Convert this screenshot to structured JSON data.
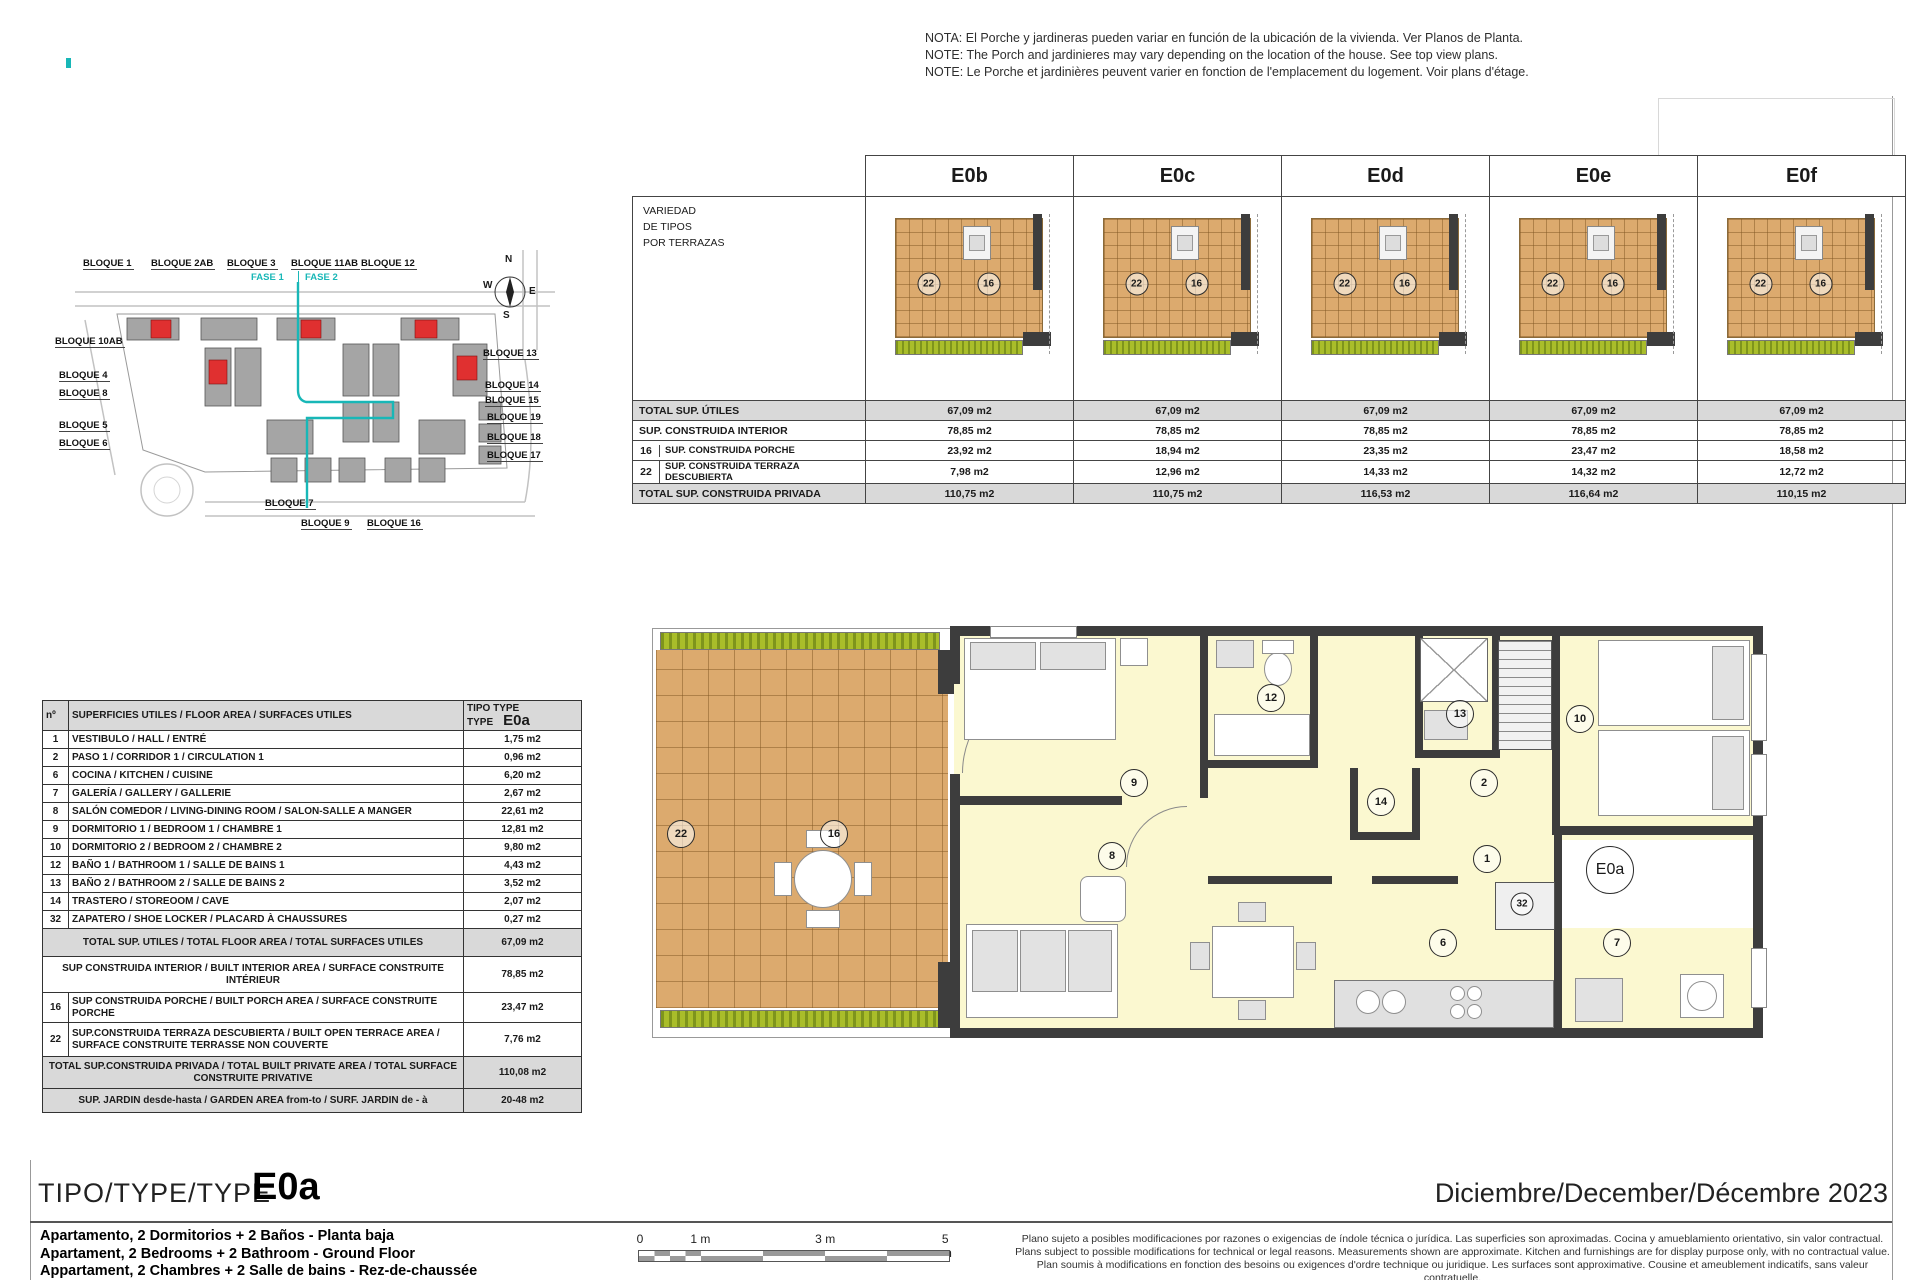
{
  "colors": {
    "accent_teal": "#18b7b7",
    "wall": "#3d3d3d",
    "room_fill": "#fbf8d0",
    "tile": "#dcaa6e",
    "garden": "#a9bd2a",
    "shade": "#d9d9d9",
    "red_block": "#e03030"
  },
  "notes": {
    "es": "NOTA: El Porche y jardineras pueden variar en función de la ubicación de la vivienda. Ver Planos de Planta.",
    "en": "NOTE: The Porch and jardinieres may vary depending on the location of the house. See top view plans.",
    "fr": "NOTE: Le Porche et jardinières peuvent varier en fonction de l'emplacement du logement. Voir plans d'étage."
  },
  "terrace_table": {
    "corner": {
      "l1": "VARIEDAD",
      "l2": "DE TIPOS",
      "l3": "POR TERRAZAS"
    },
    "types": [
      "E0b",
      "E0c",
      "E0d",
      "E0e",
      "E0f"
    ],
    "badge_left": "22",
    "badge_right": "16",
    "rows": [
      {
        "num": "",
        "label": "TOTAL SUP. ÚTILES",
        "values": [
          "67,09 m2",
          "67,09 m2",
          "67,09 m2",
          "67,09 m2",
          "67,09 m2"
        ]
      },
      {
        "num": "",
        "label": "SUP. CONSTRUIDA INTERIOR",
        "values": [
          "78,85 m2",
          "78,85 m2",
          "78,85 m2",
          "78,85 m2",
          "78,85 m2"
        ]
      },
      {
        "num": "16",
        "label": "SUP. CONSTRUIDA  PORCHE",
        "values": [
          "23,92 m2",
          "18,94 m2",
          "23,35 m2",
          "23,47 m2",
          "18,58 m2"
        ]
      },
      {
        "num": "22",
        "label": "SUP. CONSTRUIDA TERRAZA DESCUBIERTA",
        "values": [
          "7,98 m2",
          "12,96 m2",
          "14,33 m2",
          "14,32 m2",
          "12,72 m2"
        ]
      },
      {
        "num": "",
        "label": "TOTAL SUP. CONSTRUIDA PRIVADA",
        "values": [
          "110,75 m2",
          "110,75 m2",
          "116,53 m2",
          "116,64 m2",
          "110,15 m2"
        ]
      }
    ]
  },
  "site_plan": {
    "fase1": "FASE 1",
    "fase2": "FASE 2",
    "compass": {
      "n": "N",
      "e": "E",
      "s": "S",
      "w": "W"
    },
    "top": [
      "BLOQUE 1",
      "BLOQUE 2AB",
      "BLOQUE 3",
      "BLOQUE 11AB",
      "BLOQUE 12"
    ],
    "left": [
      "BLOQUE 10AB",
      "BLOQUE 4",
      "BLOQUE 8",
      "BLOQUE 5",
      "BLOQUE 6"
    ],
    "right": [
      "BLOQUE 13",
      "BLOQUE 14",
      "BLOQUE 15",
      "BLOQUE 19",
      "BLOQUE 18",
      "BLOQUE 17"
    ],
    "bottom": [
      "BLOQUE 7",
      "BLOQUE 9",
      "BLOQUE 16"
    ]
  },
  "area_table": {
    "header": {
      "num": "nº",
      "label": "SUPERFICIES UTILES / FLOOR AREA / SURFACES UTILES",
      "type1": "TIPO TYPE",
      "type2": "TYPE",
      "type_value": "E0a"
    },
    "rows": [
      {
        "num": "1",
        "label": "VESTIBULO / HALL / ENTRÉ",
        "value": "1,75 m2"
      },
      {
        "num": "2",
        "label": "PASO 1 / CORRIDOR 1 / CIRCULATION 1",
        "value": "0,96 m2"
      },
      {
        "num": "6",
        "label": "COCINA / KITCHEN / CUISINE",
        "value": "6,20 m2"
      },
      {
        "num": "7",
        "label": "GALERÍA / GALLERY / GALLERIE",
        "value": "2,67 m2"
      },
      {
        "num": "8",
        "label": "SALÓN COMEDOR  / LIVING-DINING ROOM / SALON-SALLE A MANGER",
        "value": "22,61 m2"
      },
      {
        "num": "9",
        "label": "DORMITORIO 1 / BEDROOM 1 / CHAMBRE 1",
        "value": "12,81 m2"
      },
      {
        "num": "10",
        "label": "DORMITORIO 2 / BEDROOM 2 / CHAMBRE 2",
        "value": "9,80 m2"
      },
      {
        "num": "12",
        "label": "BAÑO 1 / BATHROOM 1 / SALLE DE BAINS 1",
        "value": "4,43 m2"
      },
      {
        "num": "13",
        "label": "BAÑO 2 / BATHROOM 2 / SALLE DE BAINS 2",
        "value": "3,52 m2"
      },
      {
        "num": "14",
        "label": "TRASTERO / STOREOOM / CAVE",
        "value": "2,07 m2"
      },
      {
        "num": "32",
        "label": "ZAPATERO / SHOE LOCKER / PLACARD À CHAUSSURES",
        "value": "0,27 m2"
      }
    ],
    "summary": [
      {
        "num": "",
        "label": "TOTAL SUP. UTILES / TOTAL FLOOR AREA / TOTAL SURFACES UTILES",
        "value": "67,09 m2"
      },
      {
        "num": "",
        "label": "SUP CONSTRUIDA INTERIOR / BUILT INTERIOR AREA /  SURFACE CONSTRUITE INTÉRIEUR",
        "value": "78,85 m2"
      },
      {
        "num": "16",
        "label": "SUP CONSTRUIDA PORCHE  / BUILT PORCH  AREA / SURFACE CONSTRUITE PORCHE",
        "value": "23,47 m2"
      },
      {
        "num": "22",
        "label": "SUP.CONSTRUIDA TERRAZA DESCUBIERTA  / BUILT OPEN TERRACE  AREA / SURFACE CONSTRUITE TERRASSE NON COUVERTE",
        "value": "7,76 m2"
      },
      {
        "num": "",
        "label": "TOTAL SUP.CONSTRUIDA PRIVADA / TOTAL  BUILT PRIVATE  AREA / TOTAL SURFACE CONSTRUITE PRIVATIVE",
        "value": "110,08 m2"
      },
      {
        "num": "",
        "label": "SUP. JARDIN desde-hasta / GARDEN AREA from-to / SURF. JARDIN  de - à",
        "value": "20-48 m2"
      }
    ]
  },
  "plan": {
    "badges": {
      "t22": "22",
      "t16": "16",
      "r9": "9",
      "r8": "8",
      "r12": "12",
      "r14": "14",
      "r13": "13",
      "r2": "2",
      "r10": "10",
      "r1": "1",
      "r32": "32",
      "r6": "6",
      "r7": "7"
    },
    "type_badge": "E0a"
  },
  "footer": {
    "title_prefix": "TIPO/TYPE/TYPE",
    "title_type": "E0a",
    "date": "Diciembre/December/Décembre 2023",
    "desc1": "Apartamento, 2 Dormitorios + 2 Baños - Planta baja",
    "desc2": "Apartament, 2 Bedrooms + 2 Bathroom - Ground Floor",
    "desc3": "Appartament, 2 Chambres + 2 Salle de bains - Rez-de-chaussée",
    "scale": {
      "t0": "0",
      "t1": "1 m",
      "t3": "3 m",
      "t5": "5 m"
    },
    "legal1": "Plano sujeto a posibles modificaciones por razones o exigencias de índole técnica o jurídica. Las superficies son aproximadas. Cocina y amueblamiento orientativo, sin valor contractual.",
    "legal2": "Plans subject to possible modifications for technical or legal reasons. Measurements shown are approximate. Kitchen and furnishings are for display purpose only, with no contractual value.",
    "legal3": "Plan soumis à modifications en fonction des besoins ou exigences d'ordre technique ou juridique. Les surfaces sont approximative. Cousine et ameublement indicatifs, sans valeur contratuelle."
  }
}
